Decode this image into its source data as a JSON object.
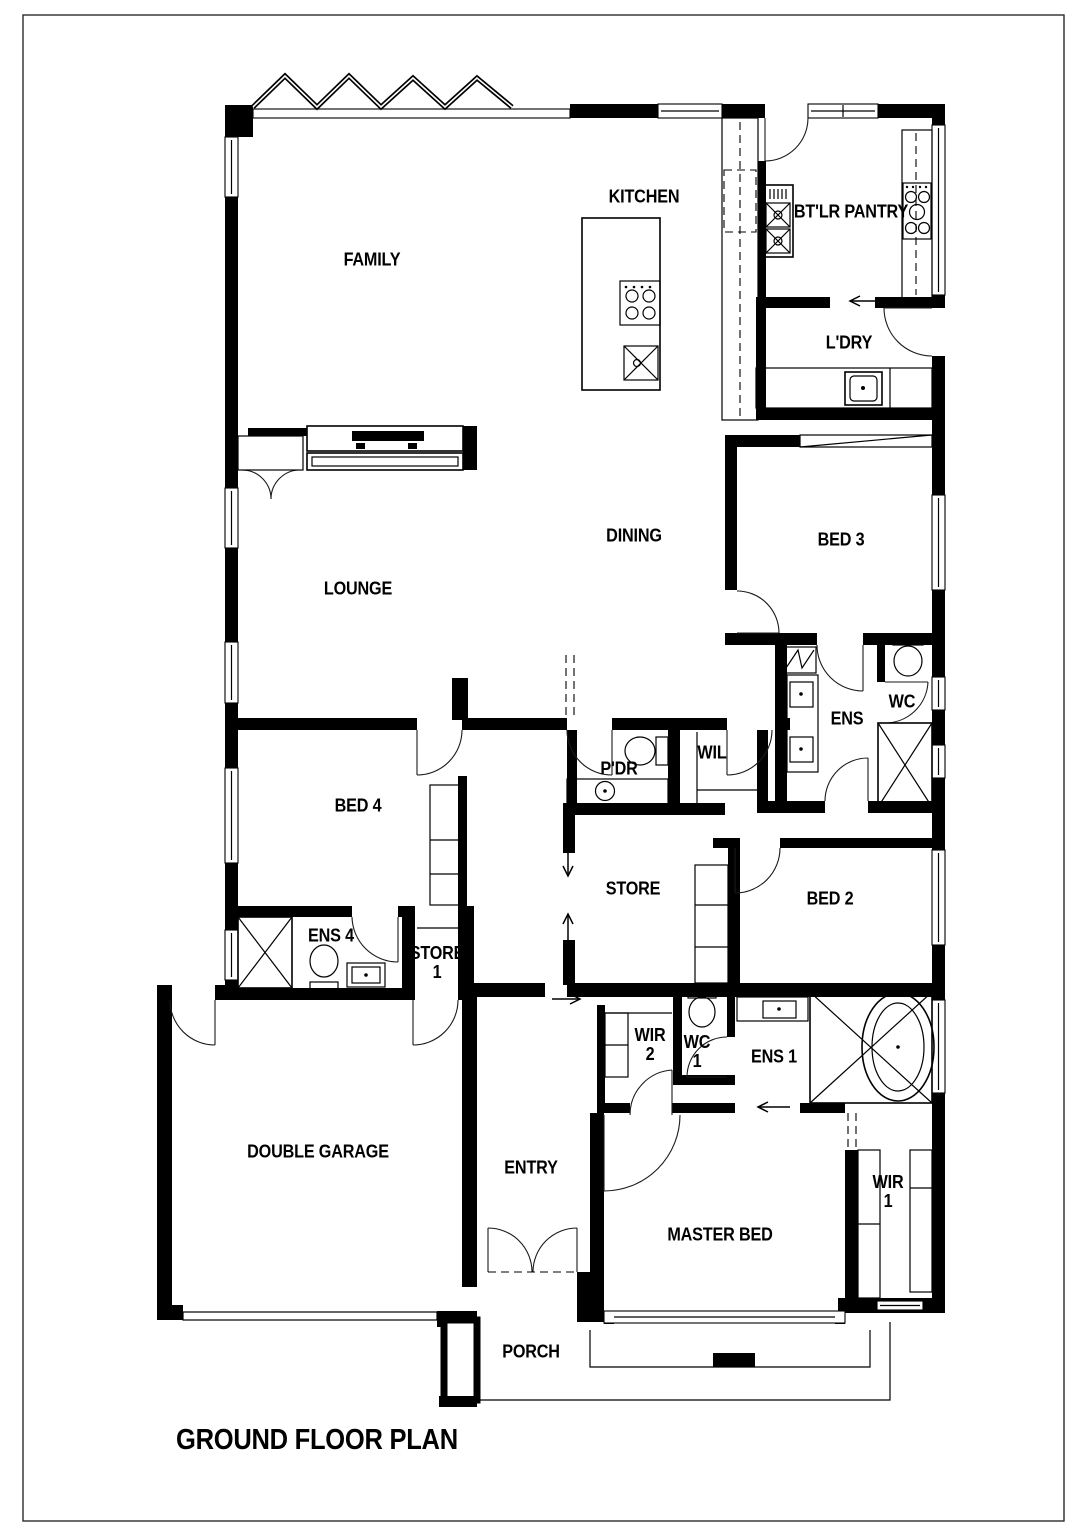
{
  "title": {
    "text": "GROUND FLOOR PLAN"
  },
  "colors": {
    "wall": "#000000",
    "line": "#1a1a1a",
    "paper": "#ffffff"
  },
  "rooms": [
    {
      "id": "family",
      "label": "FAMILY"
    },
    {
      "id": "kitchen",
      "label": "KITCHEN"
    },
    {
      "id": "butlers-pantry",
      "label": "BT'LR PANTRY"
    },
    {
      "id": "laundry",
      "label": "L'DRY"
    },
    {
      "id": "dining",
      "label": "DINING"
    },
    {
      "id": "bed-3",
      "label": "BED 3"
    },
    {
      "id": "lounge",
      "label": "LOUNGE"
    },
    {
      "id": "ens",
      "label": "ENS"
    },
    {
      "id": "wc",
      "label": "WC"
    },
    {
      "id": "powder",
      "label": "P'DR"
    },
    {
      "id": "wil",
      "label": "WIL"
    },
    {
      "id": "bed-4",
      "label": "BED 4"
    },
    {
      "id": "store",
      "label": "STORE"
    },
    {
      "id": "bed-2",
      "label": "BED 2"
    },
    {
      "id": "ens-4",
      "label": "ENS 4"
    },
    {
      "id": "store-1",
      "label": "STORE",
      "label2": "1"
    },
    {
      "id": "double-garage",
      "label": "DOUBLE GARAGE"
    },
    {
      "id": "entry",
      "label": "ENTRY"
    },
    {
      "id": "wir-2",
      "label": "WIR",
      "label2": "2"
    },
    {
      "id": "wc-1",
      "label": "WC",
      "label2": "1"
    },
    {
      "id": "ens-1",
      "label": "ENS 1"
    },
    {
      "id": "master-bed",
      "label": "MASTER BED"
    },
    {
      "id": "wir-1",
      "label": "WIR",
      "label2": "1"
    },
    {
      "id": "porch",
      "label": "PORCH"
    }
  ]
}
